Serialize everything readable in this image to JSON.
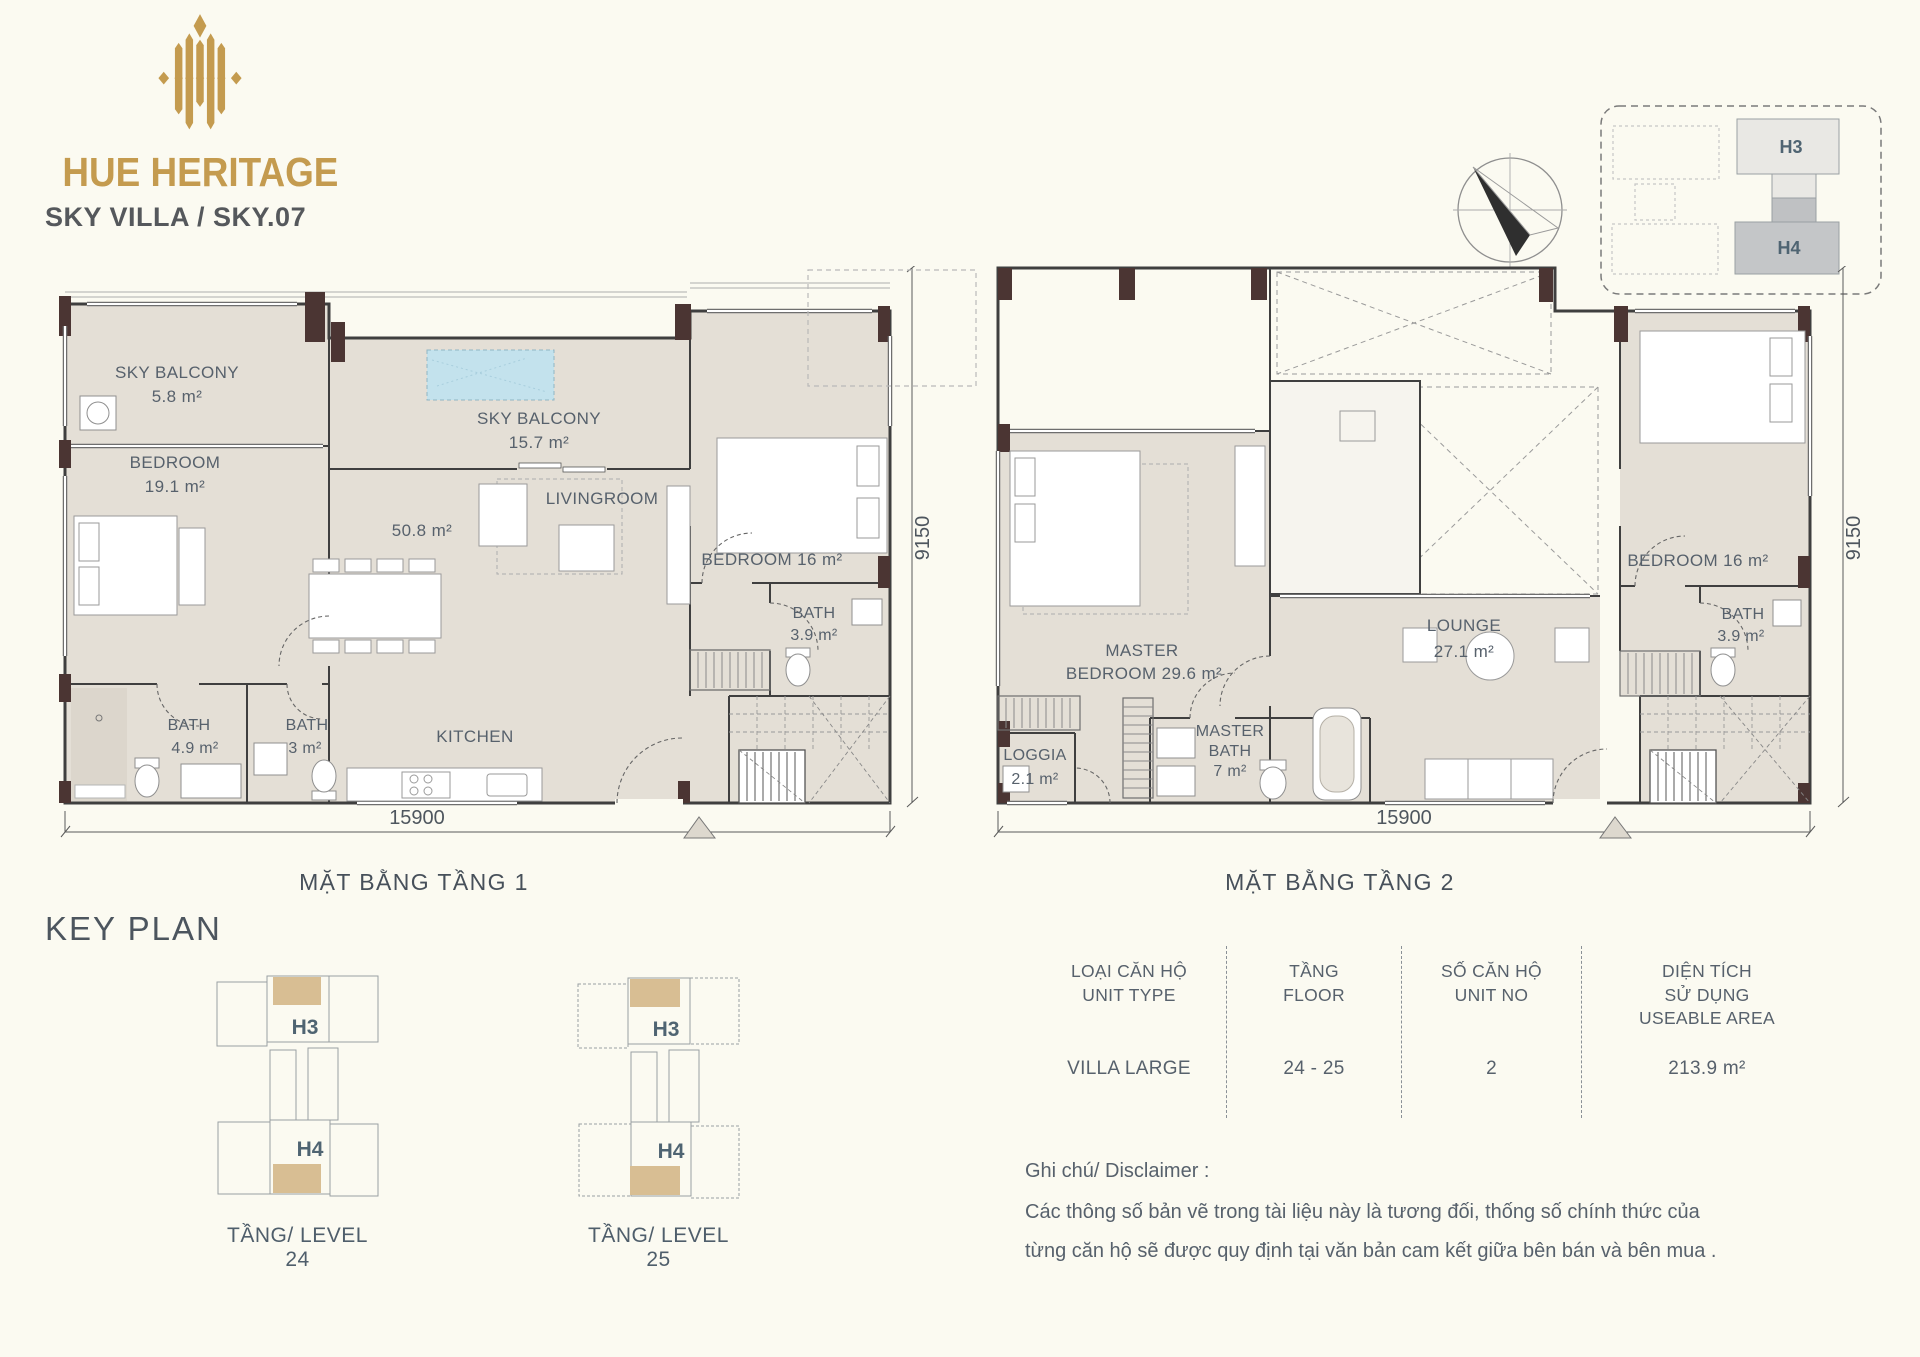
{
  "colors": {
    "background": "#FBFAF1",
    "gold": "#C49B4F",
    "floor_fill": "#E4DFD6",
    "wall": "#3F3F3F",
    "column": "#4B3533",
    "pool": "#C3E2ED",
    "label": "#57616C",
    "tan": "#D8BE93"
  },
  "header": {
    "brand": "HUE HERITAGE",
    "subtitle": "SKY VILLA / SKY.07"
  },
  "site_plan": {
    "h3": "H3",
    "h4": "H4"
  },
  "floor1": {
    "title": "MẶT BẰNG TẦNG 1",
    "dim_w": "15900",
    "dim_h": "9150",
    "sky_balcony_1": "SKY BALCONY",
    "sky_balcony_1_area": "5.8 m²",
    "bedroom_l": "BEDROOM",
    "bedroom_l_area": "19.1 m²",
    "sky_balcony_2": "SKY BALCONY",
    "sky_balcony_2_area": "15.7 m²",
    "livingroom": "LIVINGROOM",
    "livingroom_area": "50.8 m²",
    "bedroom_r": "BEDROOM 16 m²",
    "bath_r": "BATH",
    "bath_r_area": "3.9 m²",
    "bath_1": "BATH",
    "bath_1_area": "4.9 m²",
    "bath_2": "BATH",
    "bath_2_area": "3 m²",
    "kitchen": "KITCHEN"
  },
  "floor2": {
    "title": "MẶT BẰNG TẦNG 2",
    "dim_w": "15900",
    "dim_h": "9150",
    "master_line1": "MASTER",
    "master_line2": "BEDROOM 29.6 m²",
    "lounge": "LOUNGE",
    "lounge_area": "27.1 m²",
    "bedroom_r": "BEDROOM 16 m²",
    "bath_r": "BATH",
    "bath_r_area": "3.9 m²",
    "loggia": "LOGGIA",
    "loggia_area": "2.1 m²",
    "master_bath_1": "MASTER",
    "master_bath_2": "BATH",
    "master_bath_3": "7 m²"
  },
  "key_plan": {
    "title": "KEY PLAN",
    "levels": [
      {
        "h3": "H3",
        "h4": "H4",
        "caption": "TẦNG/ LEVEL 24"
      },
      {
        "h3": "H3",
        "h4": "H4",
        "caption": "TẦNG/ LEVEL 25"
      }
    ]
  },
  "table": {
    "col1": {
      "h1": "LOẠI CĂN HỘ",
      "h2": "UNIT TYPE",
      "value": "VILLA LARGE"
    },
    "col2": {
      "h1": "TẦNG",
      "h2": "FLOOR",
      "value": "24 - 25"
    },
    "col3": {
      "h1": "SỐ CĂN HỘ",
      "h2": "UNIT NO",
      "value": "2"
    },
    "col4": {
      "h1": "DIỆN TÍCH",
      "h2": "SỬ DỤNG",
      "h3": "USEABLE AREA",
      "value": "213.9 m²"
    }
  },
  "disclaimer": {
    "heading": "Ghi chú/ Disclaimer :",
    "line1": "Các thông số bản vẽ trong tài liệu này là tương đối, thống số  chính thức của",
    "line2": "từng căn hộ sẽ được quy định tại văn bản cam kết giữa bên bán và bên mua ."
  }
}
